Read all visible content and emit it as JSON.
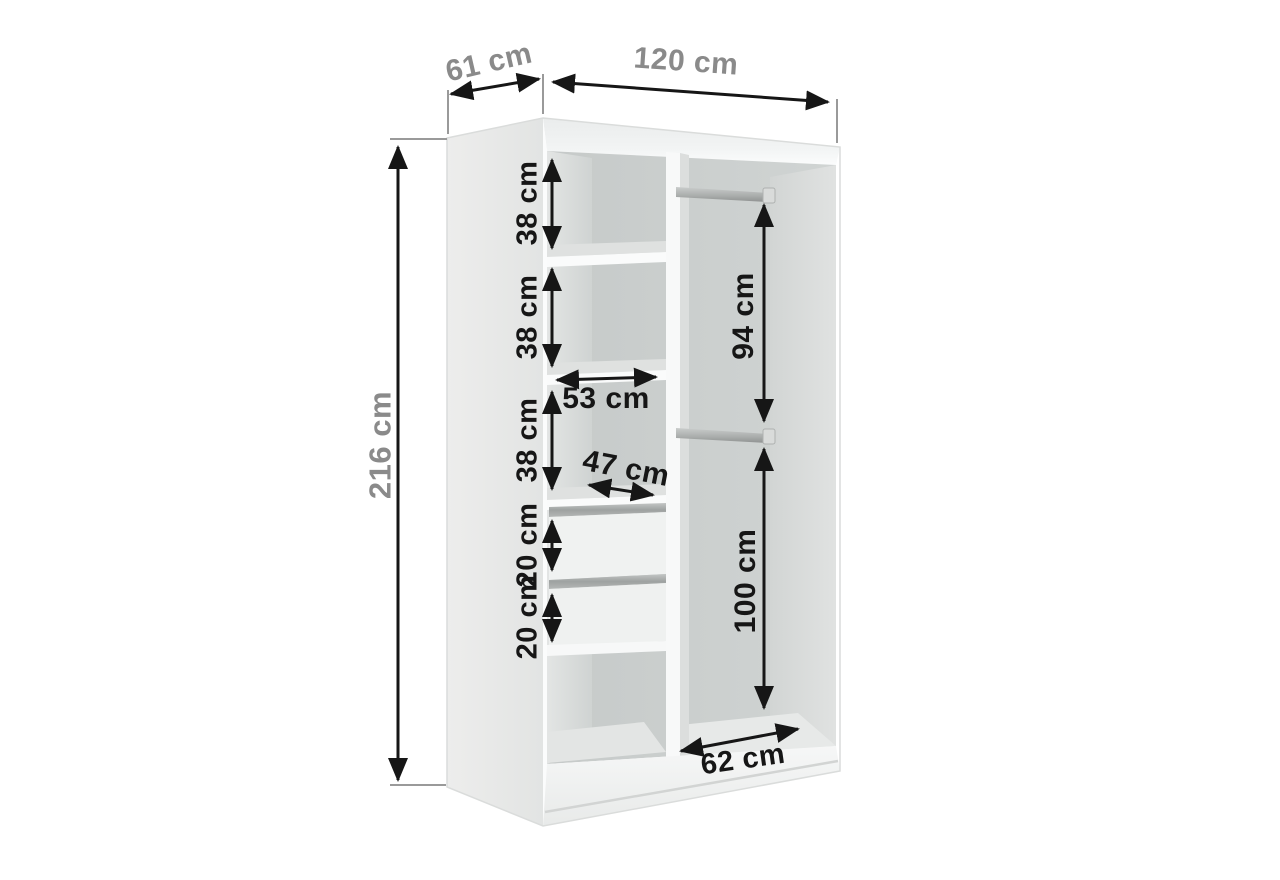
{
  "diagram": {
    "kind": "wardrobe interior dimension diagram",
    "unit": "cm",
    "colors": {
      "background": "#ffffff",
      "arrow": "#161616",
      "label_dark": "#161616",
      "label_gray": "#8a8a8a",
      "panel_light": "#f1f2f1",
      "interior_wall": "#cbcfce",
      "handle_metal": "#a7aaa9"
    },
    "dimensions": {
      "depth": "61 cm",
      "width": "120 cm",
      "height": "216 cm",
      "shelf_gap_1": "38 cm",
      "shelf_gap_2": "38 cm",
      "shelf_gap_3": "38 cm",
      "drawer_1": "20 cm",
      "drawer_2": "20 cm",
      "shelf_width": "53 cm",
      "shelf_depth": "47 cm",
      "hanging_upper_height": "94 cm",
      "hanging_lower_height": "100 cm",
      "hanging_width": "62 cm"
    }
  }
}
